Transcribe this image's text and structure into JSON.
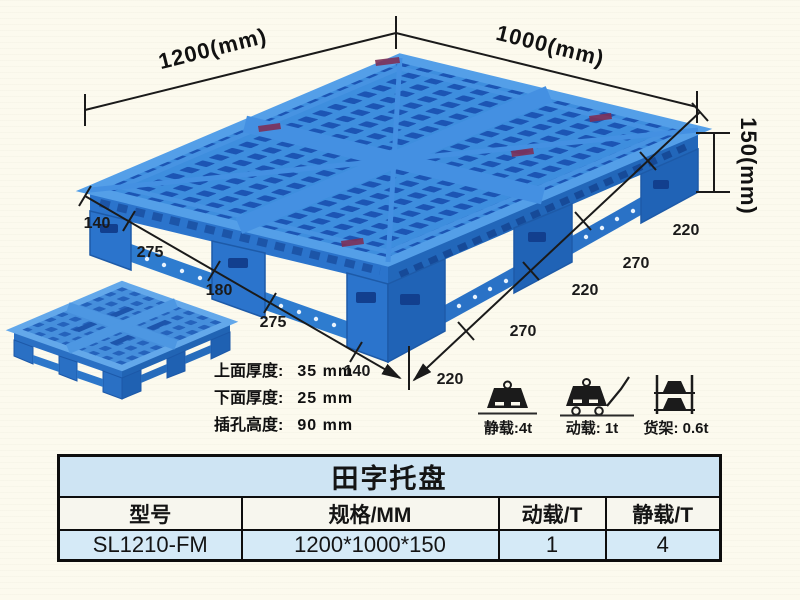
{
  "colors": {
    "pallet_blue": "#2e7fd6",
    "pallet_hole_dark": "#1c55b4",
    "pallet_highlight": "#549fe8",
    "background_cream": "#fcfaee",
    "table_header_blue": "#cee4f3",
    "annotation_black": "#1a1a1a"
  },
  "dimension_labels": {
    "length": "1200(mm)",
    "width": "1000(mm)",
    "height": "150(mm)"
  },
  "left_edge_segments": [
    "140",
    "275",
    "180",
    "275",
    "140"
  ],
  "right_edge_segments": [
    "220",
    "270",
    "220",
    "270",
    "220"
  ],
  "thickness_notes": [
    {
      "label": "上面厚度:",
      "value": "35 mm"
    },
    {
      "label": "下面厚度:",
      "value": "25 mm"
    },
    {
      "label": "插孔高度:",
      "value": "90 mm"
    }
  ],
  "load_capacity": [
    {
      "icon": "static-load-icon",
      "label": "静载:4t"
    },
    {
      "icon": "dynamic-load-icon",
      "label": "动载: 1t"
    },
    {
      "icon": "rack-load-icon",
      "label": "货架: 0.6t"
    }
  ],
  "spec_table": {
    "title": "田字托盘",
    "headers": [
      "型号",
      "规格/MM",
      "动载/T",
      "静载/T"
    ],
    "rows": [
      [
        "SL1210-FM",
        "1200*1000*150",
        "1",
        "4"
      ]
    ]
  }
}
